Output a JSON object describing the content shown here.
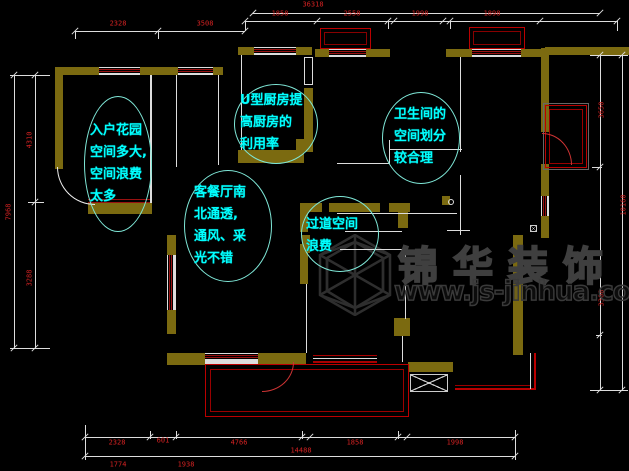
{
  "drawing": {
    "type": "apartment-floor-plan-analysis",
    "colors": {
      "background": "#000000",
      "wall_olive": "#7b6a10",
      "dimension_red": "#d42222",
      "annotation_cyan": "#00ffff",
      "ellipse_cyan": "#7fe8d8",
      "line_white": "#dddddd",
      "window_red": "#991111",
      "balcony_red": "#bb0000",
      "watermark_gray": "#3c3c3c"
    }
  },
  "annotations": [
    {
      "lines": [
        "入户花园",
        "空间多大,",
        "空间浪费",
        "太多"
      ]
    },
    {
      "lines": [
        "U型厨房提",
        "高厨房的",
        "利用率"
      ]
    },
    {
      "lines": [
        "卫生间的",
        "空间划分",
        "较合理"
      ]
    },
    {
      "lines": [
        "客餐厅南",
        "北通透,",
        "通风、采",
        "光不错"
      ]
    },
    {
      "lines": [
        "过道空间",
        "浪费"
      ]
    }
  ],
  "dimensions": {
    "top": {
      "overall": "36318",
      "segments": [
        "2328",
        "3508",
        "1858",
        "2558",
        "1998",
        "1898"
      ]
    },
    "left": {
      "overall": "7968",
      "segments": [
        "4310",
        "3288"
      ]
    },
    "right": {
      "overall": "10160",
      "segments": [
        "3650",
        "3308"
      ]
    },
    "bottom": {
      "overall": "14488",
      "segments": [
        "2328",
        "601",
        "4766",
        "1858",
        "1998"
      ],
      "edge_marks": [
        "1774",
        "1938"
      ]
    }
  },
  "watermark": {
    "brand": "锦华装饰",
    "url": "www.js-jinhua.com",
    "logo": "wireframe-cube-logo"
  }
}
